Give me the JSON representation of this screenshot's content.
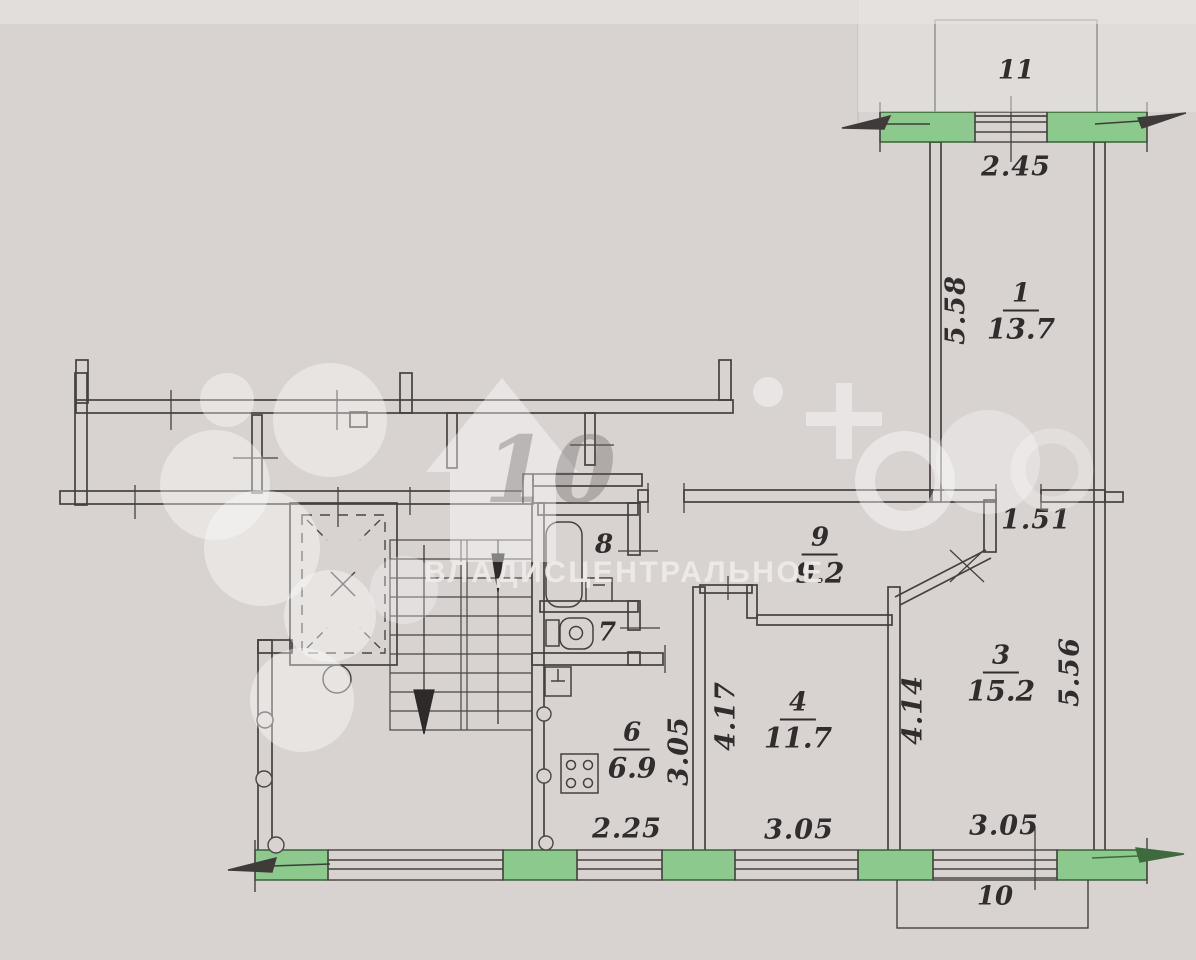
{
  "plan": {
    "rooms": [
      {
        "key": "room-1",
        "number": "1",
        "area": "13.7"
      },
      {
        "key": "room-3",
        "number": "3",
        "area": "15.2"
      },
      {
        "key": "room-4",
        "number": "4",
        "area": "11.7"
      },
      {
        "key": "room-6",
        "number": "6",
        "area": "6.9"
      },
      {
        "key": "room-7",
        "number": "7"
      },
      {
        "key": "room-8",
        "number": "8"
      },
      {
        "key": "room-9",
        "number": "9",
        "area": "9.2"
      },
      {
        "key": "balcony-10",
        "number": "10"
      },
      {
        "key": "balcony-11",
        "number": "11"
      }
    ],
    "dimensions": [
      {
        "key": "balcony11-window-width",
        "value": "2.45",
        "orientation": "horizontal"
      },
      {
        "key": "room1-depth",
        "value": "5.58",
        "orientation": "vertical"
      },
      {
        "key": "corridor-width",
        "value": "1.51",
        "orientation": "horizontal"
      },
      {
        "key": "kitchen-depth",
        "value": "3.05",
        "orientation": "vertical"
      },
      {
        "key": "room4-depth",
        "value": "4.17",
        "orientation": "vertical"
      },
      {
        "key": "room3-left-depth",
        "value": "4.14",
        "orientation": "vertical"
      },
      {
        "key": "room3-right-depth",
        "value": "5.56",
        "orientation": "vertical"
      },
      {
        "key": "kitchen-window-width",
        "value": "2.25",
        "orientation": "horizontal"
      },
      {
        "key": "room4-window-width",
        "value": "3.05",
        "orientation": "horizontal"
      },
      {
        "key": "room3-window-width",
        "value": "3.05",
        "orientation": "horizontal"
      }
    ],
    "colors": {
      "paper": "#d8d3d1",
      "wall_line": "#45403f",
      "window_wall_fill": "#8cc98c",
      "label_text": "#322d2d"
    }
  },
  "watermark": {
    "agency_text": "ВЛАДИСЦЕНТРАЛЬНОЕ",
    "house_text": "10"
  }
}
